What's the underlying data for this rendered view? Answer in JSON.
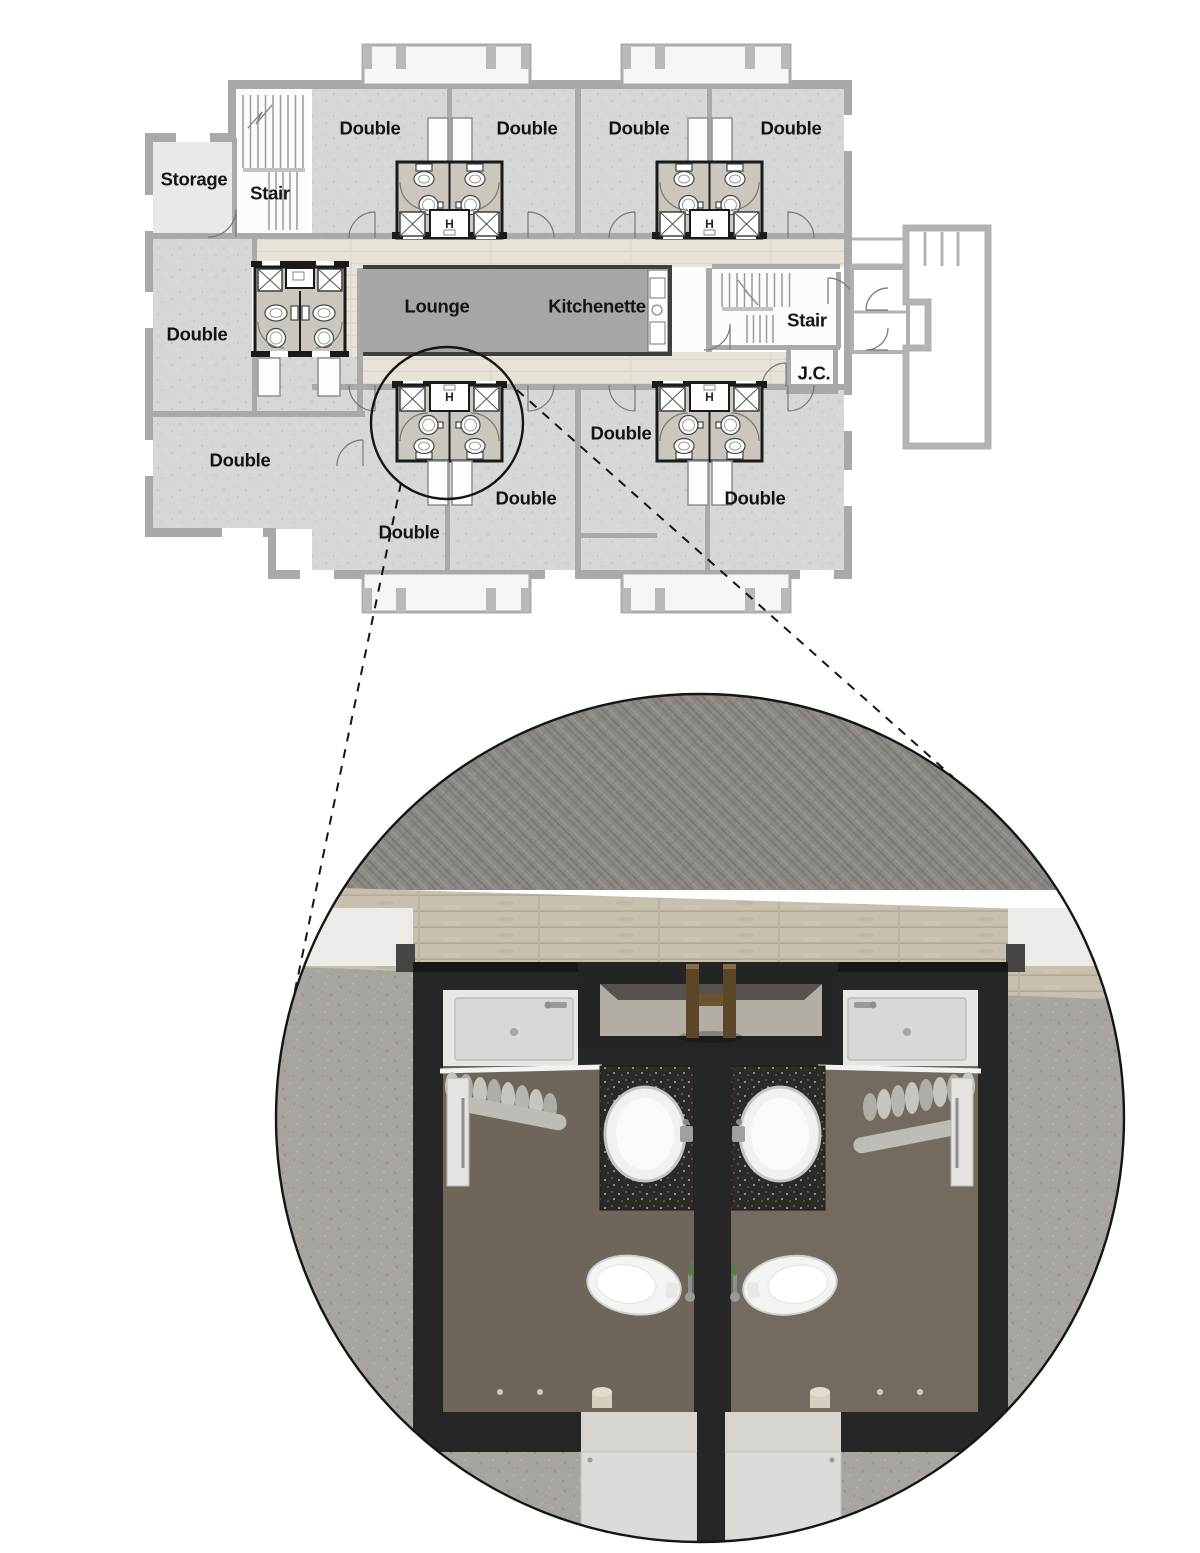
{
  "title": "Residence hall floor plan with bathroom pod detail callout",
  "floor_plan": {
    "closet_symbol": "H",
    "labels": [
      {
        "text": "Double",
        "x": 370,
        "y": 128,
        "name": "room-label-double-top-1"
      },
      {
        "text": "Double",
        "x": 527,
        "y": 128,
        "name": "room-label-double-top-2"
      },
      {
        "text": "Double",
        "x": 639,
        "y": 128,
        "name": "room-label-double-top-3"
      },
      {
        "text": "Double",
        "x": 791,
        "y": 128,
        "name": "room-label-double-top-4"
      },
      {
        "text": "Storage",
        "x": 194,
        "y": 179,
        "name": "room-label-storage"
      },
      {
        "text": "Stair",
        "x": 270,
        "y": 193,
        "name": "room-label-stair-left"
      },
      {
        "text": "Double",
        "x": 197,
        "y": 334,
        "name": "room-label-double-left"
      },
      {
        "text": "Lounge",
        "x": 437,
        "y": 306,
        "name": "room-label-lounge"
      },
      {
        "text": "Kitchenette",
        "x": 597,
        "y": 306,
        "name": "room-label-kitchenette"
      },
      {
        "text": "Stair",
        "x": 807,
        "y": 320,
        "name": "room-label-stair-right"
      },
      {
        "text": "J.C.",
        "x": 814,
        "y": 373,
        "name": "room-label-jc"
      },
      {
        "text": "Double",
        "x": 240,
        "y": 460,
        "name": "room-label-double-bottom-1"
      },
      {
        "text": "Double",
        "x": 409,
        "y": 532,
        "name": "room-label-double-bottom-2"
      },
      {
        "text": "Double",
        "x": 526,
        "y": 498,
        "name": "room-label-double-bottom-3"
      },
      {
        "text": "Double",
        "x": 621,
        "y": 433,
        "name": "room-label-double-bottom-4"
      },
      {
        "text": "Double",
        "x": 755,
        "y": 498,
        "name": "room-label-double-bottom-5"
      }
    ],
    "room_counts": {
      "double": 10,
      "stair": 2,
      "storage": 1,
      "lounge": 1,
      "kitchenette": 1,
      "janitor_closet": 1
    },
    "bathroom_pods": 5
  },
  "callout": {
    "magnifier_circle": {
      "cx": 447,
      "cy": 423,
      "r": 76
    },
    "detail_circle": {
      "cx": 700,
      "cy": 1118,
      "r": 424
    },
    "scene_elements": [
      "corridor-carpet",
      "hallway-wood-floor",
      "bathroom-pod-walls",
      "shower-left",
      "shower-right",
      "shower-curtains",
      "luggage-rack-closet",
      "vanity-sink-left",
      "vanity-sink-right",
      "toilet-left",
      "toilet-right",
      "open-door-left",
      "open-door-right",
      "bedroom-floor-left",
      "bedroom-floor-right",
      "room-door-slabs"
    ]
  },
  "colors": {
    "wall_gray": "#a9a9a9",
    "room_fill": "#d7d7d5",
    "corridor_floor": "#e8e3d8",
    "lounge_floor": "#a7a6a2",
    "pod_interior": "#cbc7be",
    "pod_wall_dark": "#262626",
    "carpet": "#8c8985",
    "wood_floor": "#c8c0af",
    "concrete_floor": "#a8a49f",
    "bath_floor": "#6f665b",
    "granite_counter": "#2d2926",
    "fixture_white": "#f2f1ef",
    "rack_wood": "#5d4527",
    "callout_line": "#151515"
  }
}
